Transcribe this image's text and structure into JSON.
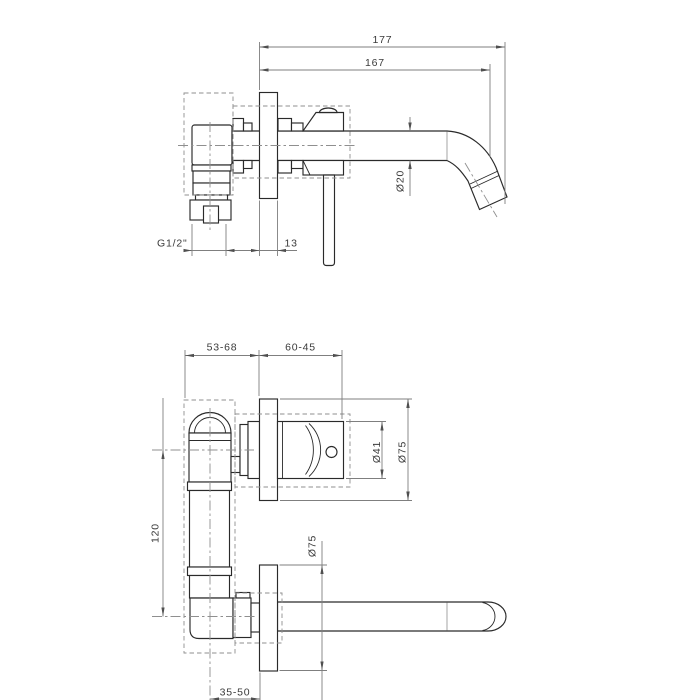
{
  "colors": {
    "background": "#ffffff",
    "part_outline": "#2a2a2a",
    "dimension_lines": "#7f7f7f",
    "dimension_text": "#3a3a3a",
    "hidden_lines": "#8f8f8f"
  },
  "top_view": {
    "dims": {
      "overall_length": "177",
      "spout_reach": "167",
      "spout_diameter": "Ø20",
      "inlet_thread": "G1/2\"",
      "plate_thickness": "13"
    }
  },
  "front_view": {
    "dims": {
      "rough_in_left": "53-68",
      "rough_in_right": "60-45",
      "handle_diameter": "Ø41",
      "upper_plate_diameter": "Ø75",
      "axis_distance": "120",
      "lower_plate_diameter": "Ø75",
      "spout_rough_in": "35-50"
    }
  }
}
